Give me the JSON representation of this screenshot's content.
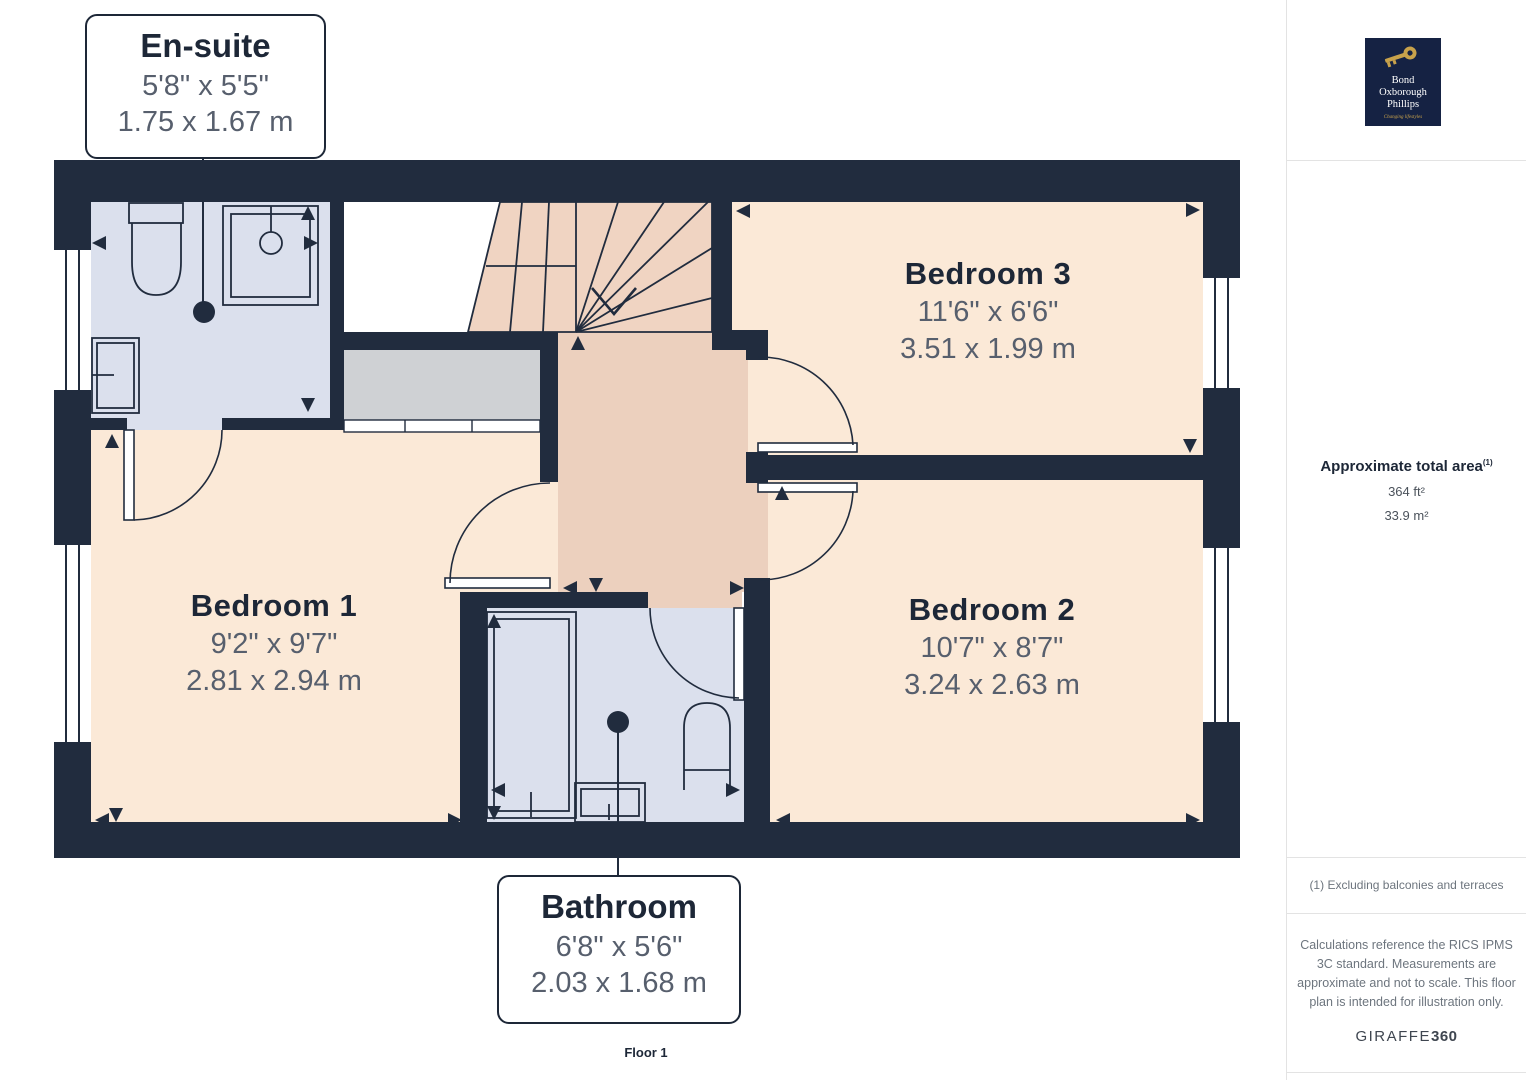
{
  "plan": {
    "floor_label": "Floor 1",
    "rooms": {
      "ensuite": {
        "name": "En-suite",
        "dims_ft": "5'8\" x 5'5\"",
        "dims_m": "1.75 x 1.67 m"
      },
      "bedroom1": {
        "name": "Bedroom 1",
        "dims_ft": "9'2\" x 9'7\"",
        "dims_m": "2.81 x 2.94 m"
      },
      "bedroom2": {
        "name": "Bedroom 2",
        "dims_ft": "10'7\" x 8'7\"",
        "dims_m": "3.24 x 2.63 m"
      },
      "bedroom3": {
        "name": "Bedroom 3",
        "dims_ft": "11'6\" x 6'6\"",
        "dims_m": "3.51 x 1.99 m"
      },
      "bathroom": {
        "name": "Bathroom",
        "dims_ft": "6'8\" x 5'6\"",
        "dims_m": "2.03 x 1.68 m"
      }
    }
  },
  "sidebar": {
    "logo": {
      "icon": "key-icon",
      "line1": "Bond",
      "line2": "Oxborough",
      "line3": "Phillips",
      "tagline": "Changing lifestyles"
    },
    "area": {
      "title": "Approximate total area",
      "title_sup": "(1)",
      "sqft": "364 ft²",
      "sqm": "33.9 m²"
    },
    "footnote": "(1) Excluding balconies and terraces",
    "disclaimer": "Calculations reference the RICS IPMS 3C standard. Measurements are approximate and not to scale. This floor plan is intended for illustration only.",
    "brand": {
      "name": "GIRAFFE",
      "suffix": "360"
    }
  },
  "colors": {
    "wall": "#212c3e",
    "bedroom_floor": "#fbe9d7",
    "hallway_floor": "#ecd0be",
    "stairs_floor": "#f0d4c2",
    "wet_room_floor": "#dbe0ed",
    "wardrobe": "#cfd1d4",
    "title_text": "#1d2737",
    "dim_text": "#575f6d",
    "logo_navy": "#152243",
    "logo_gold": "#c8a24b"
  }
}
